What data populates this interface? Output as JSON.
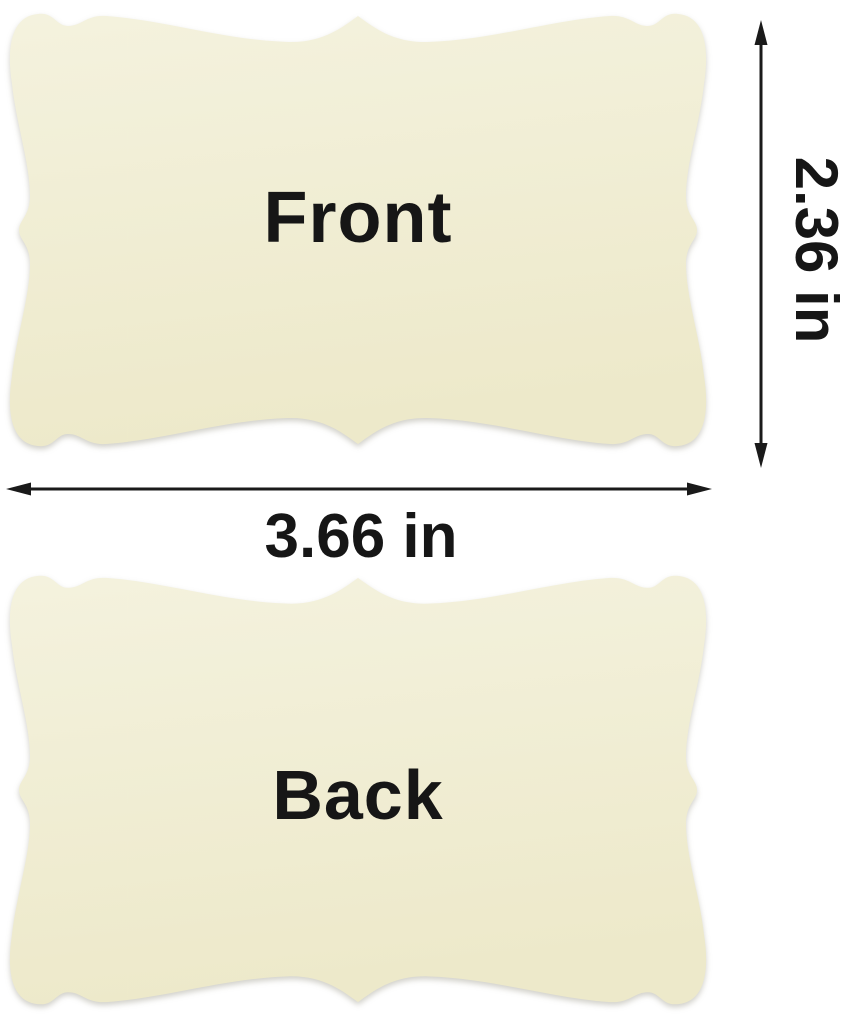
{
  "product_diagram": {
    "front_card": {
      "label": "Front"
    },
    "back_card": {
      "label": "Back"
    },
    "height_dimension": {
      "label": "2.36 in"
    },
    "width_dimension": {
      "label": "3.66 in"
    }
  },
  "colors": {
    "background": "#FFFFFF",
    "card_gradient_top": "#F4F2DE",
    "card_gradient_bottom": "#EDE9CA",
    "label_text": "#161616",
    "arrow": "#1A1A1A"
  }
}
